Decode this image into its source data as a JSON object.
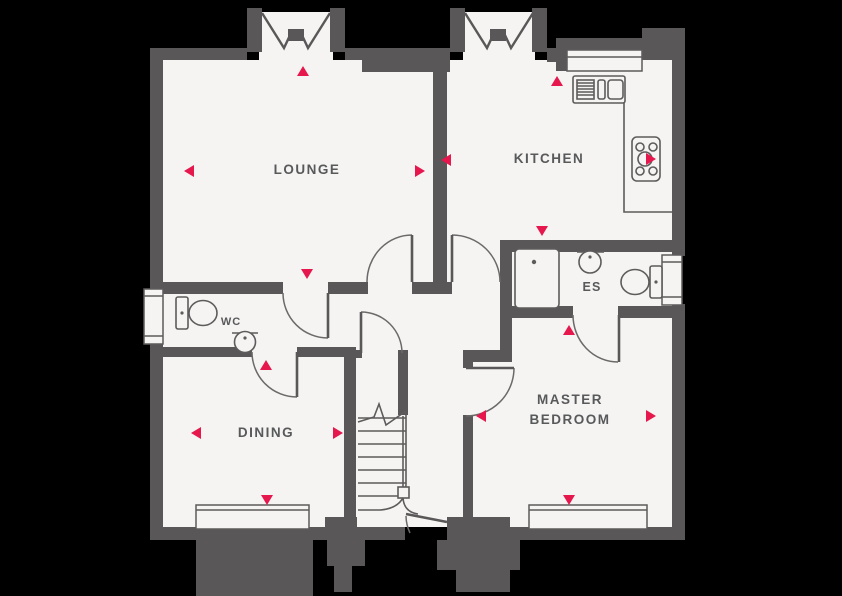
{
  "plan": {
    "title": "Ground floor plan",
    "rooms": [
      {
        "id": "lounge",
        "label": "LOUNGE"
      },
      {
        "id": "kitchen",
        "label": "KITCHEN"
      },
      {
        "id": "wc",
        "label": "WC"
      },
      {
        "id": "es",
        "label": "ES"
      },
      {
        "id": "dining",
        "label": "DINING"
      },
      {
        "id": "master-bedroom",
        "label_lines": [
          "MASTER",
          "BEDROOM"
        ]
      }
    ],
    "fixtures": [
      "kitchen-sink-icon",
      "hob-icon",
      "shower-icon",
      "basin-icon",
      "toilet-icon",
      "stairs-icon"
    ],
    "markers": [
      {
        "room": "lounge",
        "dir": "up",
        "x": 303,
        "y": 71
      },
      {
        "room": "lounge",
        "dir": "left",
        "x": 189,
        "y": 171
      },
      {
        "room": "lounge",
        "dir": "right",
        "x": 420,
        "y": 171
      },
      {
        "room": "lounge",
        "dir": "down",
        "x": 307,
        "y": 274
      },
      {
        "room": "kitchen",
        "dir": "left",
        "x": 446,
        "y": 160
      },
      {
        "room": "kitchen",
        "dir": "up",
        "x": 557,
        "y": 81
      },
      {
        "room": "kitchen",
        "dir": "right",
        "x": 651,
        "y": 159
      },
      {
        "room": "kitchen",
        "dir": "down",
        "x": 542,
        "y": 231
      },
      {
        "room": "master-bedroom",
        "dir": "up",
        "x": 569,
        "y": 330
      },
      {
        "room": "master-bedroom",
        "dir": "left",
        "x": 481,
        "y": 416
      },
      {
        "room": "master-bedroom",
        "dir": "right",
        "x": 651,
        "y": 416
      },
      {
        "room": "master-bedroom",
        "dir": "down",
        "x": 569,
        "y": 500
      },
      {
        "room": "dining",
        "dir": "up",
        "x": 266,
        "y": 365
      },
      {
        "room": "dining",
        "dir": "left",
        "x": 196,
        "y": 433
      },
      {
        "room": "dining",
        "dir": "right",
        "x": 338,
        "y": 433
      },
      {
        "room": "dining",
        "dir": "down",
        "x": 267,
        "y": 500
      }
    ],
    "colors": {
      "wall": "#595757",
      "floor": "#f5f4f2",
      "line": "#5d5b5b",
      "arc": "#6b6969",
      "marker": "#e5174d",
      "label": "#58595b",
      "background": "#000000"
    }
  }
}
